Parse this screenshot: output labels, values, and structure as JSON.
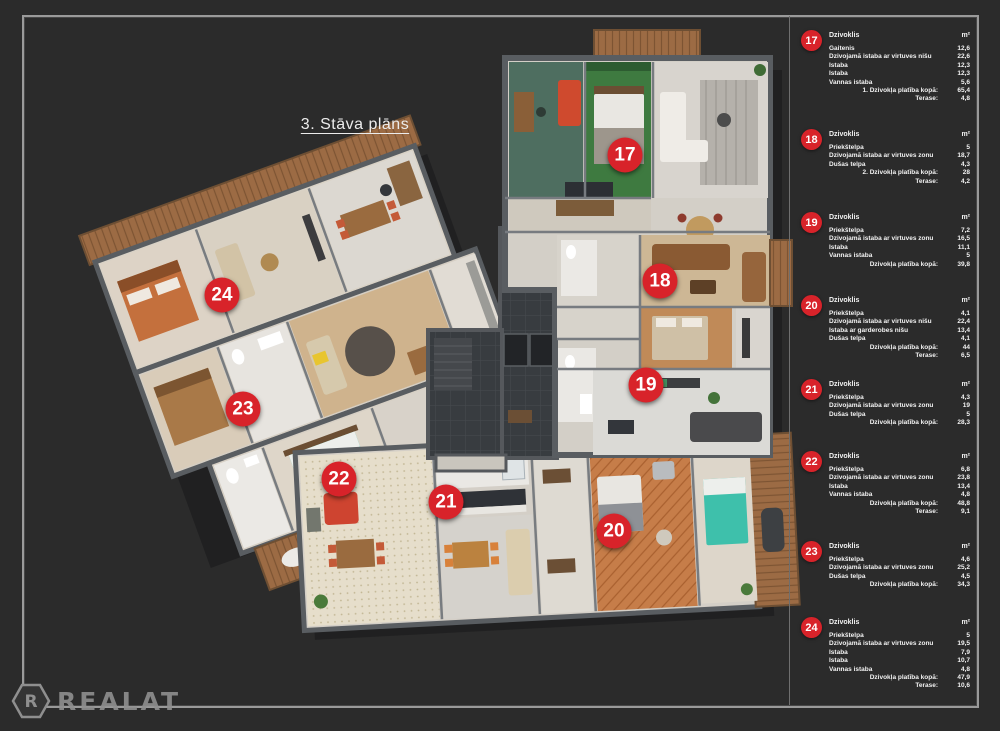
{
  "page": {
    "title": "3. Stāva plāns",
    "background": "#2b2b2b",
    "accent_red": "#d8232a",
    "logo_text": "REALAT",
    "logo_monogram": "R"
  },
  "legend": {
    "header_label": "Dzivoklis",
    "unit_label": "m²",
    "apartments": [
      {
        "number": "17",
        "rows": [
          [
            "Gaitenis",
            "12,6"
          ],
          [
            "Dzivojamā istaba ar virtuves nišu",
            "22,6"
          ],
          [
            "Istaba",
            "12,3"
          ],
          [
            "Istaba",
            "12,3"
          ],
          [
            "Vannas istaba",
            "5,6"
          ]
        ],
        "total_label": "1. Dzivokļa platība kopā:",
        "total_value": "65,4",
        "terase_label": "Terase:",
        "terase_value": "4,8"
      },
      {
        "number": "18",
        "rows": [
          [
            "Priekštelpa",
            "5"
          ],
          [
            "Dzivojamā istaba ar virtuves zonu",
            "18,7"
          ],
          [
            "Dušas telpa",
            "4,3"
          ]
        ],
        "total_label": "2. Dzivokļa platība kopā:",
        "total_value": "28",
        "terase_label": "Terase:",
        "terase_value": "4,2"
      },
      {
        "number": "19",
        "rows": [
          [
            "Priekštelpa",
            "7,2"
          ],
          [
            "Dzivojamā istaba ar virtuves zonu",
            "16,5"
          ],
          [
            "Istaba",
            "11,1"
          ],
          [
            "Vannas istaba",
            "5"
          ]
        ],
        "total_label": "Dzivokļa platība kopā:",
        "total_value": "39,8",
        "terase_label": null,
        "terase_value": null
      },
      {
        "number": "20",
        "rows": [
          [
            "Priekštelpa",
            "4,1"
          ],
          [
            "Dzivojamā istaba ar virtuves nišu",
            "22,4"
          ],
          [
            "Istaba ar garderobes nišu",
            "13,4"
          ],
          [
            "Dušas telpa",
            "4,1"
          ]
        ],
        "total_label": "Dzivokļa platība kopā:",
        "total_value": "44",
        "terase_label": "Terase:",
        "terase_value": "6,5"
      },
      {
        "number": "21",
        "rows": [
          [
            "Priekštelpa",
            "4,3"
          ],
          [
            "Dzivojamā istaba ar virtuves zonu",
            "19"
          ],
          [
            "Dušas telpa",
            "5"
          ]
        ],
        "total_label": "Dzivokļa platība kopā:",
        "total_value": "28,3",
        "terase_label": null,
        "terase_value": null
      },
      {
        "number": "22",
        "rows": [
          [
            "Priekštelpa",
            "6,8"
          ],
          [
            "Dzivojamā istaba ar virtuves zonu",
            "23,8"
          ],
          [
            "Istaba",
            "13,4"
          ],
          [
            "Vannas istaba",
            "4,8"
          ]
        ],
        "total_label": "Dzivokļa platība kopā:",
        "total_value": "48,8",
        "terase_label": "Terase:",
        "terase_value": "9,1"
      },
      {
        "number": "23",
        "rows": [
          [
            "Priekštelpa",
            "4,6"
          ],
          [
            "Dzivojamā istaba ar virtuves zonu",
            "25,2"
          ],
          [
            "Dušas telpa",
            "4,5"
          ]
        ],
        "total_label": "Dzivokļa platība kopā:",
        "total_value": "34,3",
        "terase_label": null,
        "terase_value": null
      },
      {
        "number": "24",
        "rows": [
          [
            "Priekštelpa",
            "5"
          ],
          [
            "Dzivojamā istaba ar virtuves zonu",
            "19,5"
          ],
          [
            "Istaba",
            "7,9"
          ],
          [
            "Istaba",
            "10,7"
          ],
          [
            "Vannas istaba",
            "4,8"
          ]
        ],
        "total_label": "Dzivokļa platība kopā:",
        "total_value": "47,9",
        "terase_label": "Terase:",
        "terase_value": "10,6"
      }
    ]
  },
  "plan": {
    "markers": [
      {
        "number": "17",
        "x": 625,
        "y": 155
      },
      {
        "number": "18",
        "x": 660,
        "y": 281
      },
      {
        "number": "19",
        "x": 646,
        "y": 385
      },
      {
        "number": "20",
        "x": 614,
        "y": 531
      },
      {
        "number": "21",
        "x": 446,
        "y": 502
      },
      {
        "number": "22",
        "x": 339,
        "y": 479
      },
      {
        "number": "23",
        "x": 243,
        "y": 409
      },
      {
        "number": "24",
        "x": 222,
        "y": 295
      }
    ]
  }
}
